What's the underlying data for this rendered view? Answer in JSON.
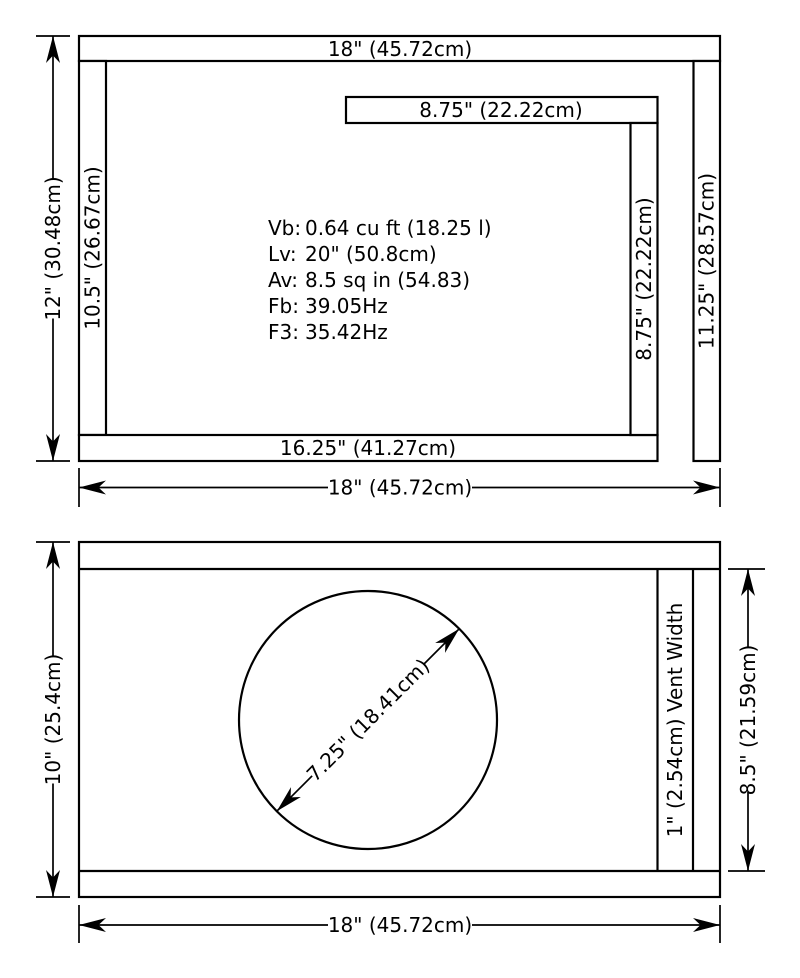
{
  "doc": {
    "background": "#ffffff",
    "line_color": "#000000"
  },
  "top_view": {
    "top_panel_label": "18\" (45.72cm)",
    "shelf_label": "8.75\" (22.22cm)",
    "bottom_panel_label": "16.25\" (41.27cm)",
    "left_panel_label": "10.5\" (26.67cm)",
    "inner_panel_label": "8.75\" (22.22cm)",
    "right_panel_label": "11.25\" (28.57cm)",
    "height_dim_label": "12\" (30.48cm)",
    "width_dim_label": "18\" (45.72cm)",
    "specs": [
      {
        "label": "Vb:",
        "value": "0.64 cu ft (18.25 l)"
      },
      {
        "label": "Lv:",
        "value": "20\" (50.8cm)"
      },
      {
        "label": "Av:",
        "value": "8.5 sq in (54.83)"
      },
      {
        "label": "Fb:",
        "value": "39.05Hz"
      },
      {
        "label": "F3:",
        "value": "35.42Hz"
      }
    ]
  },
  "front_view": {
    "height_dim_label": "10\" (25.4cm)",
    "inner_height_dim_label": "8.5\" (21.59cm)",
    "width_dim_label": "18\" (45.72cm)",
    "driver_diameter_label": "7.25\" (18.41cm)",
    "vent_label": "1\" (2.54cm) Vent Width"
  }
}
